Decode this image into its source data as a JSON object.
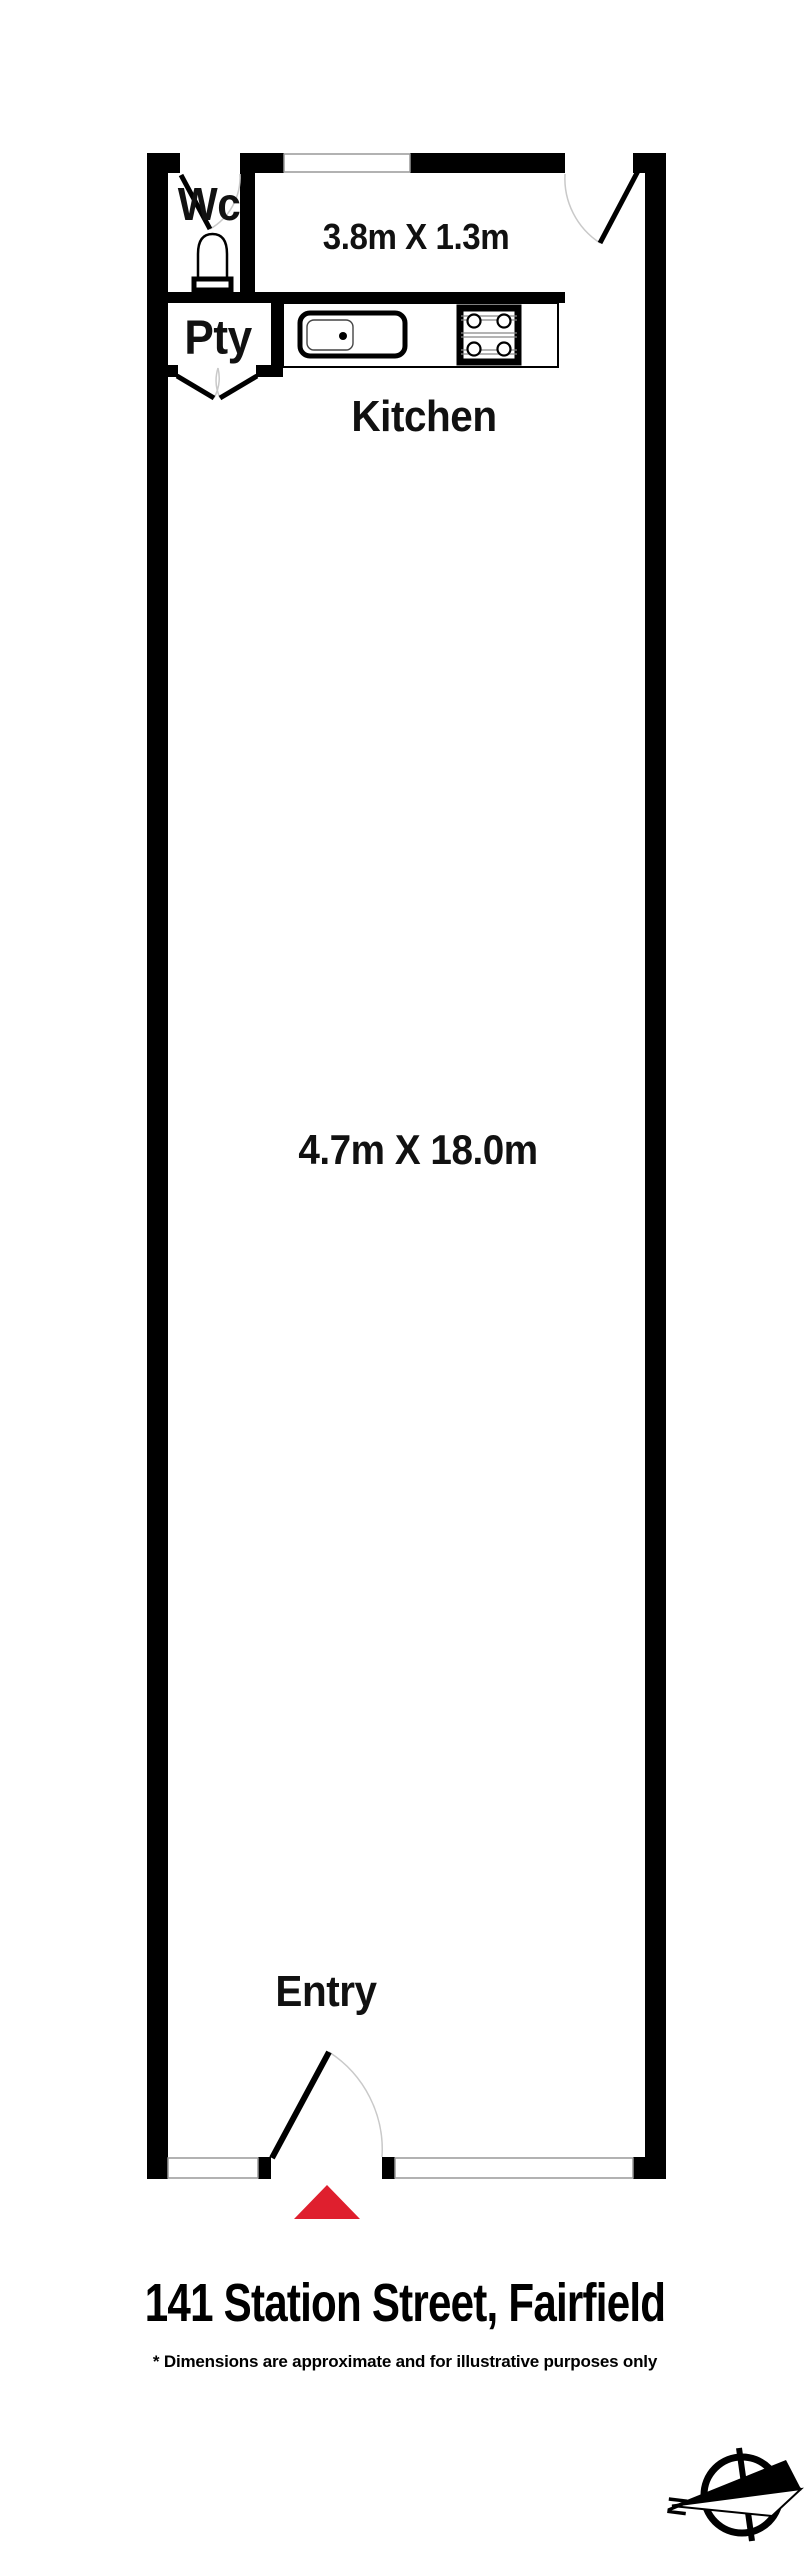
{
  "plan": {
    "labels": {
      "wc": "Wc",
      "pty": "Pty",
      "kitchen": "Kitchen",
      "kitchen_dims": "3.8m X 1.3m",
      "main_dims": "4.7m X 18.0m",
      "entry": "Entry"
    },
    "compass": {
      "north": "N"
    },
    "colors": {
      "wall": "#000000",
      "background": "#ffffff",
      "door_arc": "#c9c9c9",
      "window_outline": "#999999",
      "entry_marker": "#df1f2e"
    }
  },
  "footer": {
    "address": "141 Station Street, Fairfield",
    "disclaimer": "* Dimensions are approximate and for illustrative purposes only"
  }
}
